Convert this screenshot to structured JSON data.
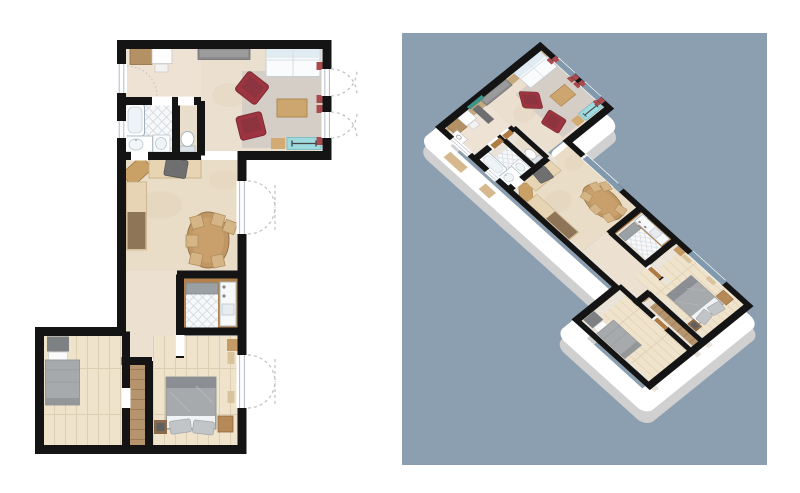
{
  "app": {
    "name": "floor-plan-viewer",
    "description": "Side-by-side apartment views: flat 2D floor plan on white canvas, 3D dollhouse perspective on blue-gray panel",
    "visible_text": []
  },
  "colors": {
    "canvas": "#ffffff",
    "panel_bg": "#8c9fb1",
    "wall": "#141414",
    "floor_beige": "#ebdfcf",
    "floor_entry": "#ede2d4",
    "floor_dining": "#eaddc8",
    "floor_hall": "#ece0d0",
    "floor_wood_light": "#f0e3cc",
    "plank_line": "#ddcfb2",
    "hall_wood": "#b5946e",
    "rug": "#d4cec6",
    "tile_bg": "#f7f8f9",
    "tile_line": "#ccd4db",
    "sofa_white": "#f9fbfc",
    "sofa_back": "#e0ecf2",
    "armchair_red": "#9c3540",
    "armchair_red_dark": "#8e3340",
    "table_wood": "#bf9765",
    "chair_tan": "#d5b486",
    "sideboard_gray": "#8d8d8d",
    "radiator_teal": "#9edade",
    "curtain_red": "#a94a4e",
    "fixture_white": "#ffffff",
    "fixture_line": "#a3b1b9",
    "bed_gray": "#a7aaac",
    "bed_dark": "#8b8f93",
    "cabinet_brown": "#b49165",
    "nightstand_brown": "#b58a58",
    "door_wood": "#ae7b42",
    "window_blue": "#8199ad",
    "wall_face": "#e9e3d9",
    "wall_face_tan": "#c5a87c",
    "facade_white": "#ffffff",
    "facade_shadow": "#d0d0d0",
    "arc_gray": "#c0c0c0",
    "window_frame": "#b3bcc4",
    "bath2_border": "#b5824e",
    "counter_gray": "#9aa0a4",
    "shelf_gray": "#6e6e70"
  },
  "panels": {
    "plan2d": {
      "name": "2d-floor-plan",
      "position": "left",
      "style": "top-down architectural plan"
    },
    "plan3d": {
      "name": "3d-floor-plan",
      "position": "right",
      "style": "rotated dollhouse cutaway",
      "background": "#8c9fb1"
    }
  },
  "rooms": [
    {
      "id": "entry",
      "furniture": [
        "cabinet",
        "white-table",
        "white-chair",
        "door-swing"
      ]
    },
    {
      "id": "living-room",
      "furniture": [
        "sideboard",
        "white-sofa",
        "red-armchair",
        "red-armchair",
        "coffee-table",
        "rug",
        "teal-radiator",
        "red-curtains"
      ]
    },
    {
      "id": "bathroom",
      "furniture": [
        "bathtub",
        "vanity-sink",
        "second-sink",
        "tiled-floor"
      ]
    },
    {
      "id": "wc",
      "furniture": [
        "toilet"
      ]
    },
    {
      "id": "dining-room",
      "furniture": [
        "corner-desk",
        "counter",
        "dark-chair",
        "bench-with-cushion",
        "oval-table",
        "six-chairs",
        "french-door"
      ]
    },
    {
      "id": "hallway",
      "furniture": []
    },
    {
      "id": "bathroom-2",
      "furniture": [
        "gray-counter",
        "tiled-shower",
        "washer-column"
      ]
    },
    {
      "id": "closet-strip",
      "furniture": []
    },
    {
      "id": "bedroom-small",
      "furniture": [
        "single-bed"
      ]
    },
    {
      "id": "bedroom-master",
      "furniture": [
        "double-bed",
        "pillows",
        "nightstand",
        "stool",
        "french-door"
      ]
    }
  ]
}
